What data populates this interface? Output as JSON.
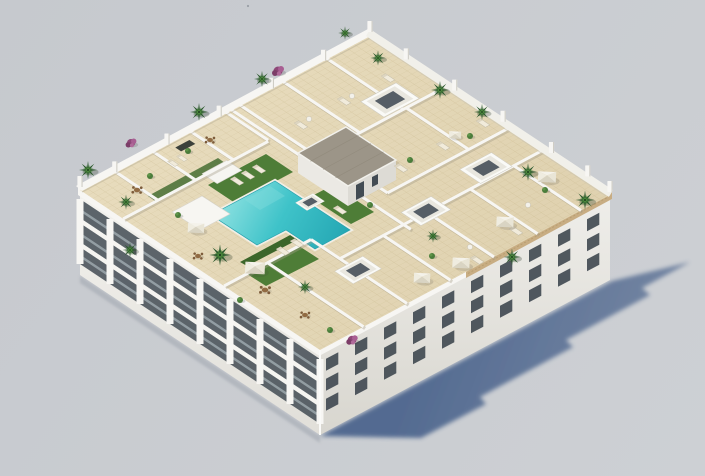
{
  "meta": {
    "title": "Rooftop pool terrace - aerial 3D architectural render",
    "description": "Aerial axonometric 3D architectural rendering of a white residential apartment block. The communal rooftop solarium has a turquoise L-shaped swimming pool, artificial lawn patches with cream sun loungers, white square parasols, potted palm trees and purple bougainvillea, white-walled private terraces with outdoor furniture, a grey-roofed stair core and white skylight boxes. The building casts a long blue-grey shadow to the lower right on a plain grey ground."
  },
  "colors": {
    "bg_top": "#c6c9ce",
    "bg_bottom": "#cdd0d4",
    "shadow": "#46608a",
    "shadow_far": "#7485a2",
    "wall_white": "#f7f6f3",
    "tile": "#e7dbbc",
    "tile_line": "#d5c7a1",
    "pool_light": "#8ae0e0",
    "pool": "#3fc3c9",
    "pool_deep": "#23a5b2",
    "lawn": "#4e7d37",
    "lawn_dark": "#3c662a",
    "palm": "#2d5a2e",
    "palm_light": "#4c8a3c",
    "bougainvillea": "#8e4878",
    "grey_roof": "#9c9588",
    "window": "#424b53",
    "glass": "#b8c4ca",
    "umbrella_light": "#f4f2ea",
    "umbrella_shade": "#d9d4c3",
    "wood": "#916b43",
    "railing_tan": "#c8ad83",
    "speck": "#8f949b"
  },
  "scene": {
    "sky": "plain light grey studio background",
    "ground": "plain grey ground plane",
    "cast_shadow": "long blue-grey building shadow cast toward the lower right",
    "speck": "tiny dark speck in the sky upper centre",
    "building": {
      "type": "white residential apartment block",
      "storeys_visible": 4,
      "southwest_facade": "three bands of recessed balconies with glass balustrades between white piers",
      "southwest_balcony_bays": 8,
      "southeast_facade": "grid of small dark windows in three rows",
      "southeast_windows": 30,
      "roof_edge_railing": "tan louvre railing along the south-east roof edge"
    },
    "rooftop": {
      "deck": "cream ceramic tile paving",
      "pool": {
        "shape": "L-shaped",
        "color_name": "turquoise",
        "surround": "white coping"
      },
      "lawns": 3,
      "hedge_strips": 1,
      "stair_core": "white stair and lift core with grey flat roof",
      "skylights": 5,
      "parasols": 7,
      "palm_trees": 15,
      "bougainvillea_shrubs": 3,
      "shrubs": 10,
      "sun_loungers": 16,
      "dining_sets": 5,
      "side_tables": 4,
      "planter_boxes": 1,
      "parapet_pillars": 13,
      "pavilions": 2,
      "private_terraces": "white-walled private terraces surrounding the communal pool deck"
    }
  }
}
